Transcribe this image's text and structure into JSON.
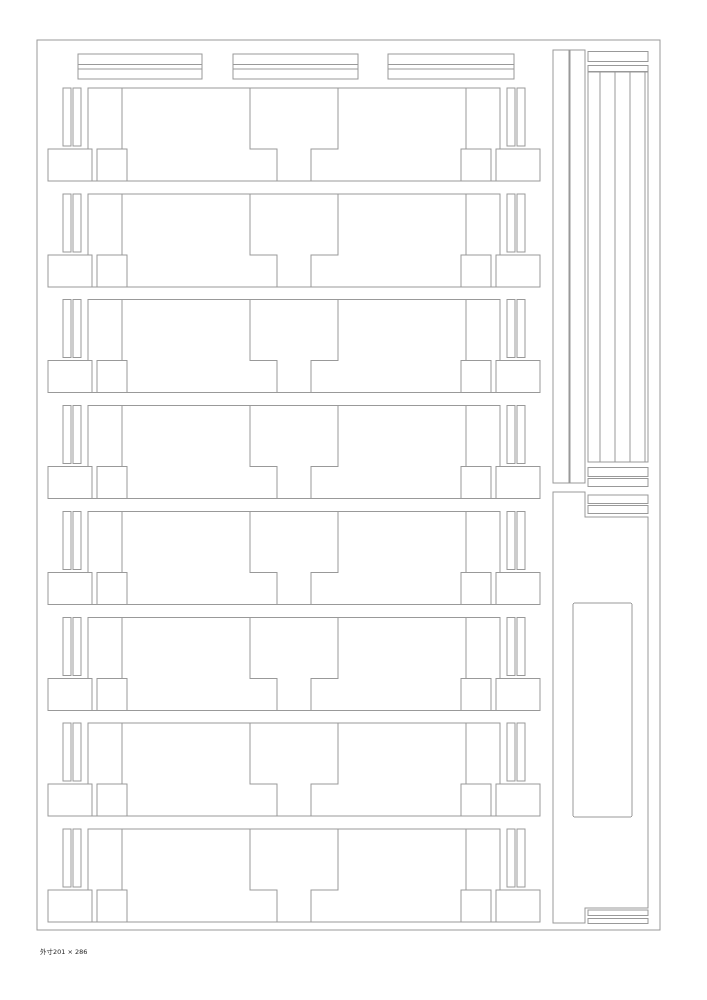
{
  "page": {
    "background": "#ffffff",
    "line_color": "#999999",
    "caption": "外寸201 × 286"
  },
  "drawing": {
    "width": 707,
    "height": 1000,
    "border": {
      "x": 37,
      "y": 40,
      "w": 623,
      "h": 890
    },
    "top_bars": {
      "y": 54,
      "h": 25,
      "divider_offsets": [
        10.3,
        15
      ],
      "bars": [
        {
          "x": 78,
          "w": 124
        },
        {
          "x": 233,
          "w": 125
        },
        {
          "x": 388,
          "w": 126
        }
      ]
    },
    "rows": {
      "x": 48,
      "tops": [
        88,
        193.9,
        299.7,
        405.6,
        511.4,
        617.3,
        723.1,
        829
      ],
      "w": 492,
      "h": 93,
      "strips": [
        [
          15,
          0,
          8,
          58
        ],
        [
          25,
          0,
          8,
          58
        ],
        [
          459,
          0,
          8,
          58
        ],
        [
          469,
          0,
          8,
          58
        ]
      ],
      "feet": [
        [
          0,
          61,
          44,
          32
        ],
        [
          49,
          61,
          30,
          32
        ],
        [
          413,
          61,
          30,
          32
        ],
        [
          448,
          61,
          44,
          32
        ]
      ],
      "bar_path": "M40,61 L40,0 L452,0 L452,61",
      "leg_paths": [
        "M74,0 L74,61 L79,61 L79,93",
        "M418,0 L418,61 L413,61 L413,93",
        "M202,0 L202,61 L229,61 L229,93",
        "M290,0 L290,61 L263,61 L263,93"
      ],
      "baseline": [
        0,
        93,
        492,
        93
      ]
    },
    "right_column": {
      "strip_pair": [
        [
          553,
          50,
          16,
          433
        ],
        [
          570,
          50,
          15,
          433
        ]
      ],
      "cap_bars": [
        [
          588,
          51.7,
          60,
          10
        ],
        [
          588,
          65.5,
          60,
          6
        ]
      ],
      "strip_group": {
        "rect": [
          588,
          72,
          60,
          390
        ],
        "verticals": [
          600,
          615,
          630,
          645
        ]
      },
      "mid_bars": [
        [
          588,
          467.3,
          60,
          9.4
        ],
        [
          588,
          478.3,
          60,
          8.4
        ],
        [
          588,
          495,
          60,
          8.3
        ],
        [
          588,
          505.3,
          60,
          8
        ],
        [
          588,
          910,
          60,
          5.5
        ],
        [
          588,
          918.3,
          60,
          5.2
        ]
      ],
      "big_part_path": "M553,492 L585,492 L585,517 L648,517 L648,908 L585,908 L585,923 L553,923 Z",
      "inner_rect": [
        573,
        603,
        59,
        214
      ]
    }
  }
}
